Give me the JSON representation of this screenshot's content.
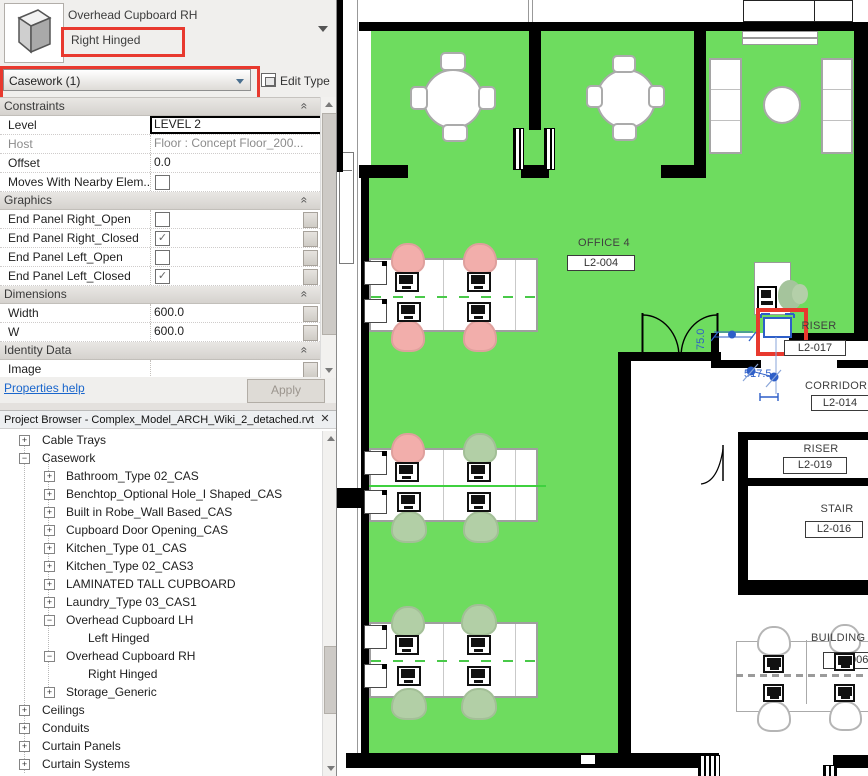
{
  "props": {
    "type_name": "Overhead Cupboard RH",
    "type_variant": "Right Hinged",
    "selector_value": "Casework (1)",
    "edit_type_label": "Edit Type",
    "collapse_glyph": "«",
    "groups": [
      {
        "name": "Constraints",
        "rows": [
          {
            "label": "Level",
            "value": "LEVEL 2"
          },
          {
            "label": "Host",
            "value": "Floor : Concept Floor_200..."
          },
          {
            "label": "Offset",
            "value": "0.0"
          },
          {
            "label": "Moves With Nearby Elem...",
            "check": ""
          }
        ]
      },
      {
        "name": "Graphics",
        "rows": [
          {
            "label": "End Panel Right_Open",
            "check": ""
          },
          {
            "label": "End Panel Right_Closed",
            "check": "✓"
          },
          {
            "label": "End Panel Left_Open",
            "check": ""
          },
          {
            "label": "End Panel Left_Closed",
            "check": "✓"
          }
        ]
      },
      {
        "name": "Dimensions",
        "rows": [
          {
            "label": "Width",
            "value": "600.0"
          },
          {
            "label": "W",
            "value": "600.0"
          }
        ]
      },
      {
        "name": "Identity Data",
        "rows": [
          {
            "label": "Image",
            "value": ""
          },
          {
            "label": "Comments",
            "value": ""
          }
        ]
      }
    ],
    "help_link": "Properties help",
    "apply_label": "Apply"
  },
  "browser": {
    "title": "Project Browser - Complex_Model_ARCH_Wiki_2_detached.rvt",
    "close_glyph": "✕",
    "items": [
      {
        "label": "Cable Trays",
        "glyph": "+"
      },
      {
        "label": "Casework",
        "glyph": "−"
      },
      {
        "label": "Bathroom_Type 02_CAS",
        "glyph": "+"
      },
      {
        "label": "Benchtop_Optional Hole_I Shaped_CAS",
        "glyph": "+"
      },
      {
        "label": "Built in Robe_Wall Based_CAS",
        "glyph": "+"
      },
      {
        "label": "Cupboard Door Opening_CAS",
        "glyph": "+"
      },
      {
        "label": "Kitchen_Type 01_CAS",
        "glyph": "+"
      },
      {
        "label": "Kitchen_Type 02_CAS3",
        "glyph": "+"
      },
      {
        "label": "LAMINATED TALL CUPBOARD",
        "glyph": "+"
      },
      {
        "label": "Laundry_Type 03_CAS1",
        "glyph": "+"
      },
      {
        "label": "Overhead Cupboard LH",
        "glyph": "−"
      },
      {
        "label": "Left Hinged",
        "glyph": ""
      },
      {
        "label": "Overhead Cupboard RH",
        "glyph": "−"
      },
      {
        "label": "Right Hinged",
        "glyph": ""
      },
      {
        "label": "Storage_Generic",
        "glyph": "+"
      },
      {
        "label": "Ceilings",
        "glyph": "+"
      },
      {
        "label": "Conduits",
        "glyph": "+"
      },
      {
        "label": "Curtain Panels",
        "glyph": "+"
      },
      {
        "label": "Curtain Systems",
        "glyph": "+"
      },
      {
        "label": "Curtain Wall Mullions",
        "glyph": "+"
      }
    ]
  },
  "plan": {
    "rooms": {
      "office": {
        "name": "OFFICE 4",
        "tag": "L2-004"
      },
      "riser1": {
        "name": "RISER",
        "tag": "L2-017"
      },
      "corridor": {
        "name": "CORRIDOR",
        "tag": "L2-014"
      },
      "riser2": {
        "name": "RISER",
        "tag": "L2-019"
      },
      "stair": {
        "name": "STAIR",
        "tag": "L2-016"
      },
      "building": {
        "name": "BUILDING",
        "tag": "006"
      }
    },
    "dims": {
      "d1": "517.5",
      "d2": "75.0"
    },
    "colors": {
      "room_fill": "#6edc5f",
      "selection": "#2e5fc8",
      "highlight": "#e8392e",
      "chair_pink": "#f2aeab",
      "chair_sage": "#b2cfa6"
    }
  }
}
